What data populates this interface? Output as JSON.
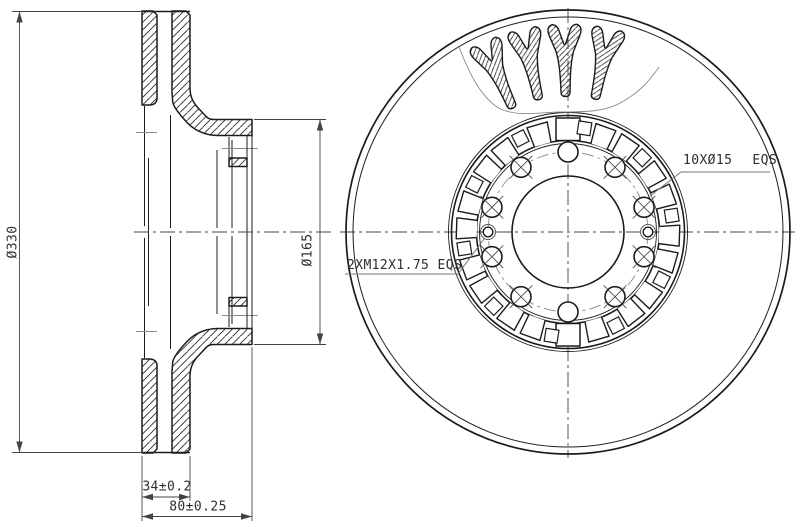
{
  "dimensions": {
    "outer_diameter": "Ø330",
    "hat_diameter": "Ø165",
    "ring_thickness": "34±0.2",
    "total_width": "80±0.25"
  },
  "labels": {
    "bolt_holes_qty": "10XØ15",
    "bolt_holes_note": "EQS",
    "thread_holes": "2XM12X1.75 EQS"
  },
  "drawing": {
    "colors": {
      "ink": "#1c1c1c",
      "thin": "#444444",
      "aux": "#8a8a8a",
      "leader": "#777777"
    },
    "section": {
      "mirror_y": 464,
      "metal_paths": [
        "M142,11 L153,11 L157,15 L157,98 Q157,104.5 150,105 L142,105 Z",
        "M172,11 L186,11 L190,15 L190,88 C190,99 195,105 201,111 C206,116 207,119.5 214,119.5 L252,119.5 L252,135.5 L218,135.5 C205,135.5 194,130 187,122.5 C180,115 175.5,109.5 173.5,104.5 C172,101.5 172.8,97 172,93 Z",
        "M229,158 L247,158 L247,166.5 L229,166.5 Z"
      ],
      "half_lines": [
        [
          142,
          11.5,
          190,
          11.5,
          "k2"
        ],
        [
          229,
          137,
          229,
          167,
          "k1"
        ],
        [
          229,
          158,
          247,
          158,
          "k1"
        ],
        [
          144.5,
          106,
          144.5,
          226,
          "k1"
        ],
        [
          170.5,
          115,
          170.5,
          228,
          "k1"
        ],
        [
          217,
          150,
          217,
          228,
          "k1"
        ],
        [
          232,
          140,
          232,
          228,
          "k1"
        ],
        [
          222,
          148.5,
          258,
          148.5,
          "a"
        ],
        [
          136,
          132.5,
          157,
          132.5,
          "a"
        ]
      ],
      "static_lines": [
        [
          148.5,
          158,
          148.5,
          306,
          "k1"
        ],
        [
          247,
          135.5,
          247,
          328.5,
          "k1"
        ],
        [
          252,
          135.5,
          252,
          328.5,
          "k1"
        ]
      ],
      "centerline": [
        134,
        232,
        332,
        232
      ]
    },
    "front": {
      "cx": 568,
      "cy": 232,
      "outer_r": 222,
      "chamfer_r": 215,
      "band_r1": 119.5,
      "band_r2": 116.5,
      "hat_r1": 91.5,
      "hat_r2": 88.5,
      "bore_r": 56,
      "pitch_r": 80,
      "hole_r": 10,
      "hole_count": 10,
      "m12_outer_r": 7.5,
      "m12_inner_r": 4.8,
      "teeth": {
        "inner_r": 91.5,
        "outer_r": 112,
        "sectors": 20,
        "tab_halfwidth": 12,
        "sq_inner": 98.5,
        "sq_outer": 111.5,
        "sq_halfwidth": 6.5
      },
      "centerline_v": [
        568,
        8,
        568,
        458
      ],
      "centerline_h": [
        340,
        232,
        795,
        232
      ],
      "cutaway": "M459,47 C470,75 480,95 497,107 C515,118 540,112 560,112 C585,112 605,112 622,102 C640,92 650,80 659,67",
      "vane_angles": [
        -24,
        -12.5,
        -1,
        11.5
      ],
      "vane_path": "M-4.5,-140 C-5,-160 -6,-170 -8.5,-180 L-15.5,-197 Q-18.5,-205 -12.5,-207.5 Q-7,-207.5 -5,-200 L-1.2,-189 Q0,-186 1.2,-189 L5,-200 Q7,-207.5 12.5,-207.5 Q18.5,-205 15.5,-197 L8.5,-180 C6,-170 5,-160 4.5,-140 Q4.5,-135.5 0,-135.5 Q-4.5,-135.5 -4.5,-140 Z"
    },
    "dims": {
      "ext_lines": [
        [
          12,
          11.5,
          143,
          11.5
        ],
        [
          12,
          452.5,
          143,
          452.5
        ],
        [
          254,
          119.5,
          326,
          119.5
        ],
        [
          254,
          344.5,
          326,
          344.5
        ],
        [
          142,
          456,
          142,
          521
        ],
        [
          190,
          456,
          190,
          501
        ],
        [
          252,
          347,
          252,
          521
        ]
      ],
      "v_dims": [
        {
          "x": 19.5,
          "y1": 11.5,
          "y2": 452.5
        },
        {
          "x": 320,
          "y1": 119.5,
          "y2": 344.5
        }
      ],
      "h_dims": [
        {
          "y": 497,
          "x1": 142,
          "x2": 190
        },
        {
          "y": 516.5,
          "x1": 142,
          "x2": 252
        }
      ]
    },
    "leaders": {
      "holes": [
        [
          650,
          196
        ],
        [
          681,
          172
        ],
        [
          770,
          172
        ]
      ],
      "thread": [
        [
          345,
          274
        ],
        [
          458,
          274
        ],
        [
          484,
          239
        ]
      ]
    }
  }
}
